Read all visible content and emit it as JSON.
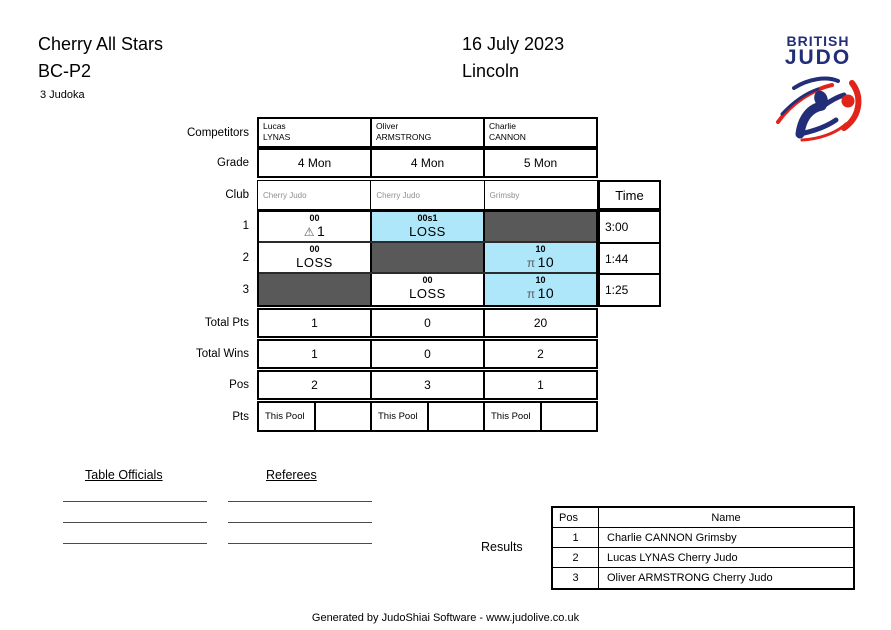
{
  "header": {
    "title": "Cherry All Stars",
    "category": "BC-P2",
    "judoka_count": "3 Judoka",
    "date": "16 July 2023",
    "location": "Lincoln"
  },
  "logo": {
    "line1": "BRITISH",
    "line2": "JUDO",
    "navy": "#232e78",
    "red": "#e2231a"
  },
  "pool": {
    "labels": {
      "competitors": "Competitors",
      "grade": "Grade",
      "club": "Club",
      "time": "Time",
      "total_pts": "Total Pts",
      "total_wins": "Total Wins",
      "pos": "Pos",
      "pts": "Pts",
      "this_pool": "This Pool"
    },
    "competitors": [
      {
        "first_name": "Lucas",
        "last_name": "LYNAS",
        "grade": "4 Mon",
        "club": "Cherry Judo",
        "total_pts": "1",
        "total_wins": "1",
        "pos": "2"
      },
      {
        "first_name": "Oliver",
        "last_name": "ARMSTRONG",
        "grade": "4 Mon",
        "club": "Cherry Judo",
        "total_pts": "0",
        "total_wins": "0",
        "pos": "3"
      },
      {
        "first_name": "Charlie",
        "last_name": "CANNON",
        "grade": "5 Mon",
        "club": "Grimsby",
        "total_pts": "20",
        "total_wins": "2",
        "pos": "1"
      }
    ],
    "matches": [
      {
        "label": "1",
        "time": "3:00",
        "cells": [
          {
            "style": "white",
            "score_top": "00",
            "symbol": "⚠",
            "result": "1"
          },
          {
            "style": "cyan",
            "score_top": "00s1",
            "result": "LOSS"
          },
          {
            "style": "gray"
          }
        ]
      },
      {
        "label": "2",
        "time": "1:44",
        "cells": [
          {
            "style": "white",
            "score_top": "00",
            "result": "LOSS"
          },
          {
            "style": "gray"
          },
          {
            "style": "cyan",
            "score_top": "10",
            "symbol": "π",
            "result": "10"
          }
        ]
      },
      {
        "label": "3",
        "time": "1:25",
        "cells": [
          {
            "style": "gray"
          },
          {
            "style": "white",
            "score_top": "00",
            "result": "LOSS"
          },
          {
            "style": "cyan",
            "score_top": "10",
            "symbol": "π",
            "result": "10"
          }
        ]
      }
    ],
    "colors": {
      "winner_highlight": "#ade7f9",
      "not_playing": "#595959"
    }
  },
  "signatures": {
    "table_officials_label": "Table Officials",
    "referees_label": "Referees"
  },
  "results": {
    "label": "Results",
    "headers": {
      "pos": "Pos",
      "name": "Name"
    },
    "rows": [
      {
        "pos": "1",
        "name": "Charlie CANNON Grimsby"
      },
      {
        "pos": "2",
        "name": "Lucas LYNAS Cherry Judo"
      },
      {
        "pos": "3",
        "name": "Oliver ARMSTRONG Cherry Judo"
      }
    ]
  },
  "footer": "Generated by JudoShiai Software - www.judolive.co.uk"
}
